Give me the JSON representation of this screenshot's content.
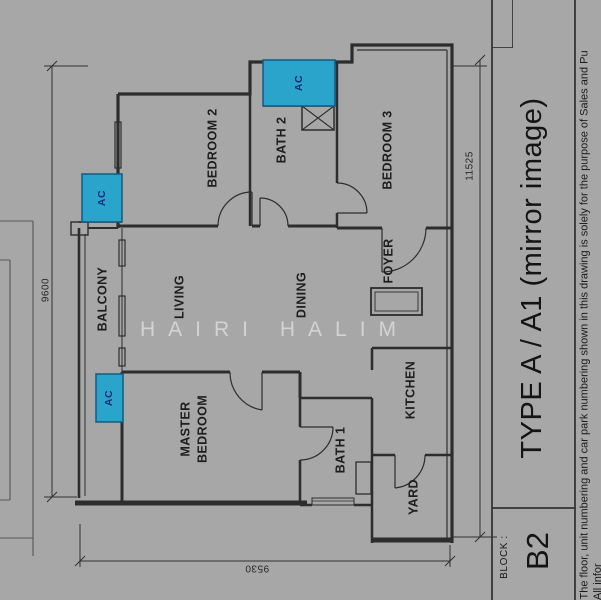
{
  "canvas": {
    "background_color": "#a7a7a7",
    "line_color": "#2d2d2d"
  },
  "watermark": "HAIRI HALIM",
  "plan": {
    "rooms": {
      "bedroom2": "BEDROOM 2",
      "bath2": "BATH 2",
      "bedroom3": "BEDROOM 3",
      "balcony": "BALCONY",
      "living": "LIVING",
      "dining": "DINING",
      "foyer": "FOYER",
      "master_line1": "MASTER",
      "master_line2": "BEDROOM",
      "bath1": "BATH 1",
      "kitchen": "KITCHEN",
      "yard": "YARD"
    },
    "ac_label": "AC",
    "ac_color": "#2ba4cb",
    "ac_border_color": "#135a84",
    "ac_text_color": "#0d2f7d",
    "dimensions": {
      "left": "9600",
      "right": "11525",
      "bottom": "9530"
    }
  },
  "title_block": {
    "block_label": "BLOCK :",
    "block_value": "B2",
    "unit_type": "TYPE A / A1 (mirror image)",
    "disclaimer_line1": "The floor, unit numbering and car park numbering shown in this drawing is solely for the purpose of Sales and Pu",
    "disclaimer_line2": "All infor"
  }
}
